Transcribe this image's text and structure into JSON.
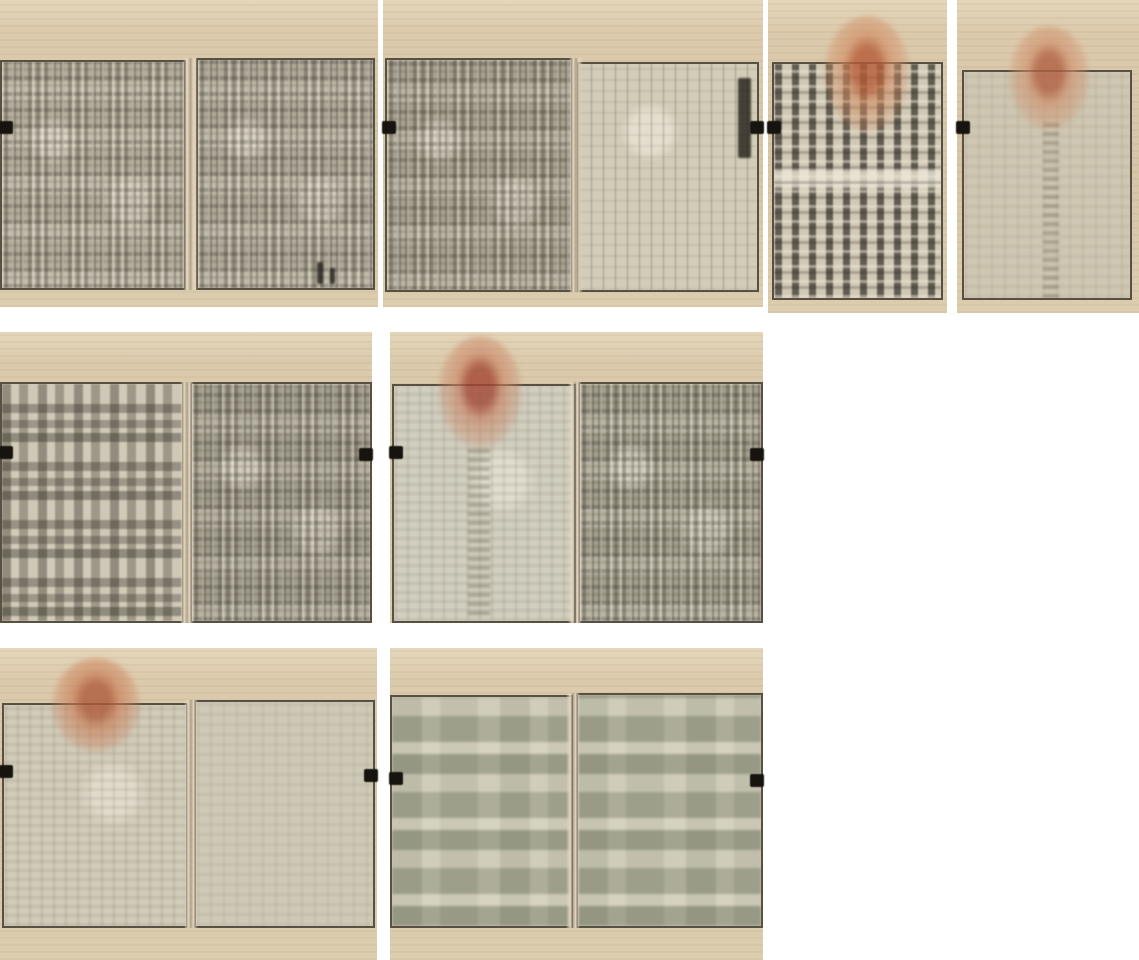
{
  "collage": {
    "canvas": {
      "w": 1139,
      "h": 960,
      "background": "#ffffff"
    },
    "palette": {
      "paper": "#d8c7a9",
      "paper_light": "#e5d7bb",
      "frame": "#3c362a",
      "tab": "#17140f",
      "seal_red": "#b55a36"
    },
    "panels": [
      {
        "name": "spread-1-text-pages",
        "x": 0,
        "y": 0,
        "w": 378,
        "h": 307,
        "pages": [
          {
            "x": 0,
            "y": 60,
            "w": 186,
            "h": 230,
            "texture": "dense",
            "tone": "#b4ad9c"
          },
          {
            "x": 196,
            "y": 58,
            "w": 179,
            "h": 232,
            "texture": "dense",
            "tone": "#b0a999"
          }
        ],
        "folds": [
          {
            "x": 183,
            "y": 58,
            "w": 15,
            "h": 232
          }
        ],
        "seals": [],
        "tabs": [
          {
            "side": "left",
            "y": 121
          }
        ],
        "marks": [
          {
            "type": "dark",
            "x": 317,
            "y": 262,
            "w": 6,
            "h": 22
          },
          {
            "type": "dark",
            "x": 330,
            "y": 268,
            "w": 5,
            "h": 16
          }
        ]
      },
      {
        "name": "spread-2-text-and-blank-ruled-page",
        "x": 383,
        "y": 0,
        "w": 380,
        "h": 307,
        "pages": [
          {
            "x": 2,
            "y": 58,
            "w": 188,
            "h": 234,
            "texture": "dense",
            "tone": "#a9a291"
          },
          {
            "x": 194,
            "y": 62,
            "w": 182,
            "h": 230,
            "texture": "ruled",
            "tone": "#d3ccb9"
          }
        ],
        "folds": [
          {
            "x": 186,
            "y": 58,
            "w": 14,
            "h": 234
          }
        ],
        "seals": [],
        "tabs": [
          {
            "side": "left",
            "y": 121
          },
          {
            "side": "right",
            "y": 121
          }
        ],
        "marks": [
          {
            "type": "dark",
            "x": 355,
            "y": 78,
            "w": 13,
            "h": 80
          }
        ]
      },
      {
        "name": "title-page-with-seal",
        "x": 768,
        "y": 0,
        "w": 179,
        "h": 313,
        "pages": [
          {
            "x": 4,
            "y": 62,
            "w": 171,
            "h": 238,
            "texture": "title",
            "tone": "#c7bfab"
          }
        ],
        "folds": [],
        "seals": [
          {
            "x": 56,
            "y": 16,
            "w": 86,
            "h": 116,
            "core": "#b55a36",
            "outer": "#d08a5f"
          }
        ],
        "tabs": [
          {
            "side": "left",
            "y": 121
          }
        ],
        "marks": []
      },
      {
        "name": "faded-page-with-seal",
        "x": 957,
        "y": 0,
        "w": 182,
        "h": 313,
        "pages": [
          {
            "x": 5,
            "y": 70,
            "w": 170,
            "h": 230,
            "texture": "faint",
            "tone": "#cfc7b2"
          }
        ],
        "folds": [],
        "seals": [
          {
            "x": 52,
            "y": 26,
            "w": 80,
            "h": 104,
            "core": "#b05f42",
            "outer": "#cf8d68"
          }
        ],
        "tabs": [
          {
            "side": "left",
            "y": 121
          }
        ],
        "marks": [
          {
            "type": "faintcol",
            "x": 86,
            "y": 120,
            "w": 16,
            "h": 178
          }
        ]
      },
      {
        "name": "spread-3-contents-and-text",
        "x": 0,
        "y": 332,
        "w": 372,
        "h": 291,
        "pages": [
          {
            "x": 0,
            "y": 50,
            "w": 184,
            "h": 241,
            "texture": "toc",
            "tone": "#bfb8a6"
          },
          {
            "x": 190,
            "y": 50,
            "w": 182,
            "h": 241,
            "texture": "dense",
            "tone": "#a39d8d"
          }
        ],
        "folds": [
          {
            "x": 180,
            "y": 50,
            "w": 14,
            "h": 241
          }
        ],
        "seals": [],
        "tabs": [
          {
            "side": "left",
            "y": 114
          },
          {
            "side": "right",
            "y": 116
          }
        ],
        "marks": []
      },
      {
        "name": "spread-4-seal-page-and-text",
        "x": 390,
        "y": 332,
        "w": 373,
        "h": 291,
        "pages": [
          {
            "x": 2,
            "y": 52,
            "w": 184,
            "h": 239,
            "texture": "sparse",
            "tone": "#d2cfc0"
          },
          {
            "x": 188,
            "y": 50,
            "w": 185,
            "h": 241,
            "texture": "dense",
            "tone": "#a49f8e"
          }
        ],
        "folds": [
          {
            "x": 178,
            "y": 50,
            "w": 14,
            "h": 241
          }
        ],
        "seals": [
          {
            "x": 48,
            "y": 4,
            "w": 84,
            "h": 112,
            "core": "#a34634",
            "outer": "#c98261"
          }
        ],
        "tabs": [
          {
            "side": "left",
            "y": 114
          },
          {
            "side": "right",
            "y": 116
          }
        ],
        "marks": [
          {
            "type": "faintcol",
            "x": 78,
            "y": 115,
            "w": 22,
            "h": 168
          }
        ]
      },
      {
        "name": "spread-5-seal-page-and-light-text",
        "x": 0,
        "y": 648,
        "w": 377,
        "h": 312,
        "pages": [
          {
            "x": 2,
            "y": 55,
            "w": 186,
            "h": 225,
            "texture": "sparse",
            "tone": "#d2ccba"
          },
          {
            "x": 194,
            "y": 52,
            "w": 181,
            "h": 228,
            "texture": "faint",
            "tone": "#cfc9b7"
          }
        ],
        "folds": [
          {
            "x": 184,
            "y": 52,
            "w": 14,
            "h": 228
          }
        ],
        "seals": [
          {
            "x": 52,
            "y": 10,
            "w": 88,
            "h": 94,
            "core": "#ad5a3a",
            "outer": "#ca7a52"
          }
        ],
        "tabs": [
          {
            "side": "left",
            "y": 117
          },
          {
            "side": "right",
            "y": 121
          }
        ],
        "marks": []
      },
      {
        "name": "spread-6-block-printed-pages",
        "x": 390,
        "y": 648,
        "w": 373,
        "h": 312,
        "pages": [
          {
            "x": 0,
            "y": 47,
            "w": 183,
            "h": 233,
            "texture": "patchy",
            "tone": "#c6c2b0"
          },
          {
            "x": 186,
            "y": 45,
            "w": 187,
            "h": 235,
            "texture": "patchy",
            "tone": "#c4c1ae"
          }
        ],
        "folds": [
          {
            "x": 176,
            "y": 45,
            "w": 14,
            "h": 235
          }
        ],
        "seals": [],
        "tabs": [
          {
            "side": "left",
            "y": 124
          },
          {
            "side": "right",
            "y": 126
          }
        ],
        "marks": []
      }
    ]
  }
}
